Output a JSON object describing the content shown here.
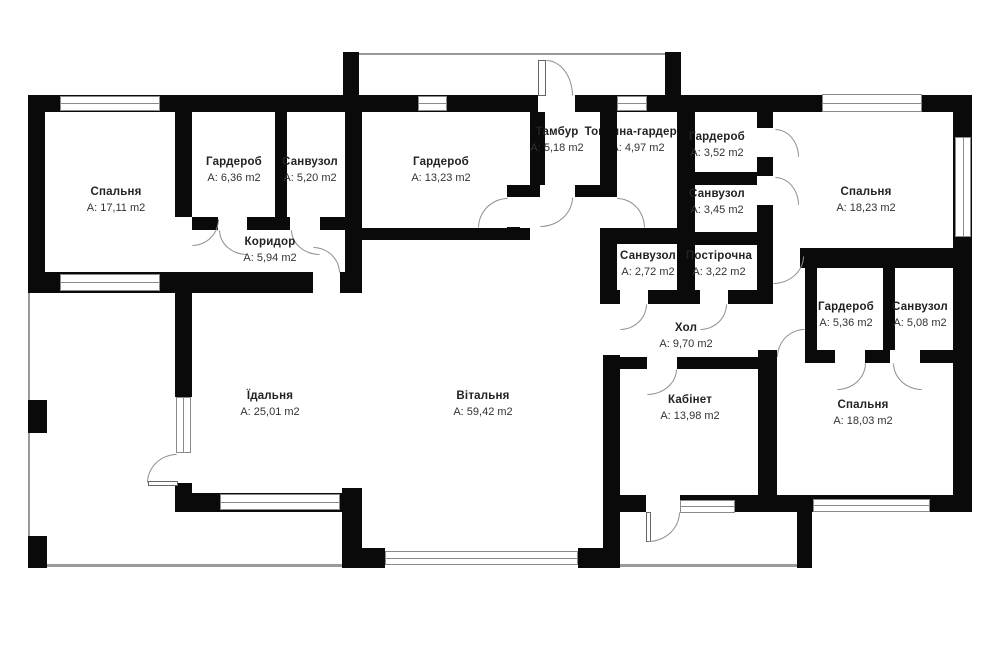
{
  "plan": {
    "background": "#ffffff",
    "wall_color": "#0a0a0a",
    "line_color": "#8a8a8a",
    "unit": "m2",
    "rooms": [
      {
        "name": "Спальня",
        "area": "A: 17,11 m2"
      },
      {
        "name": "Гардероб",
        "area": "A: 6,36 m2"
      },
      {
        "name": "Санвузол",
        "area": "A: 5,20 m2"
      },
      {
        "name": "Коридор",
        "area": "A: 5,94 m2"
      },
      {
        "name": "Гардероб",
        "area": "A: 13,23 m2"
      },
      {
        "name": "Тамбур",
        "area": "A: 5,18 m2"
      },
      {
        "name": "Топочна-гардероб",
        "area": "A: 4,97 m2"
      },
      {
        "name": "Гардероб",
        "area": "A: 3,52 m2"
      },
      {
        "name": "Санвузол",
        "area": "A: 3,45 m2"
      },
      {
        "name": "Спальня",
        "area": "A: 18,23 m2"
      },
      {
        "name": "Санвузол",
        "area": "A: 2,72 m2"
      },
      {
        "name": "Постірочна",
        "area": "A: 3,22 m2"
      },
      {
        "name": "Хол",
        "area": "A: 9,70 m2"
      },
      {
        "name": "Гардероб",
        "area": "A: 5,36 m2"
      },
      {
        "name": "Санвузол",
        "area": "A: 5,08 m2"
      },
      {
        "name": "Їдальня",
        "area": "A: 25,01 m2"
      },
      {
        "name": "Вітальня",
        "area": "A: 59,42 m2"
      },
      {
        "name": "Кабінет",
        "area": "A: 13,98 m2"
      },
      {
        "name": "Спальня",
        "area": "A: 18,03 m2"
      }
    ]
  }
}
